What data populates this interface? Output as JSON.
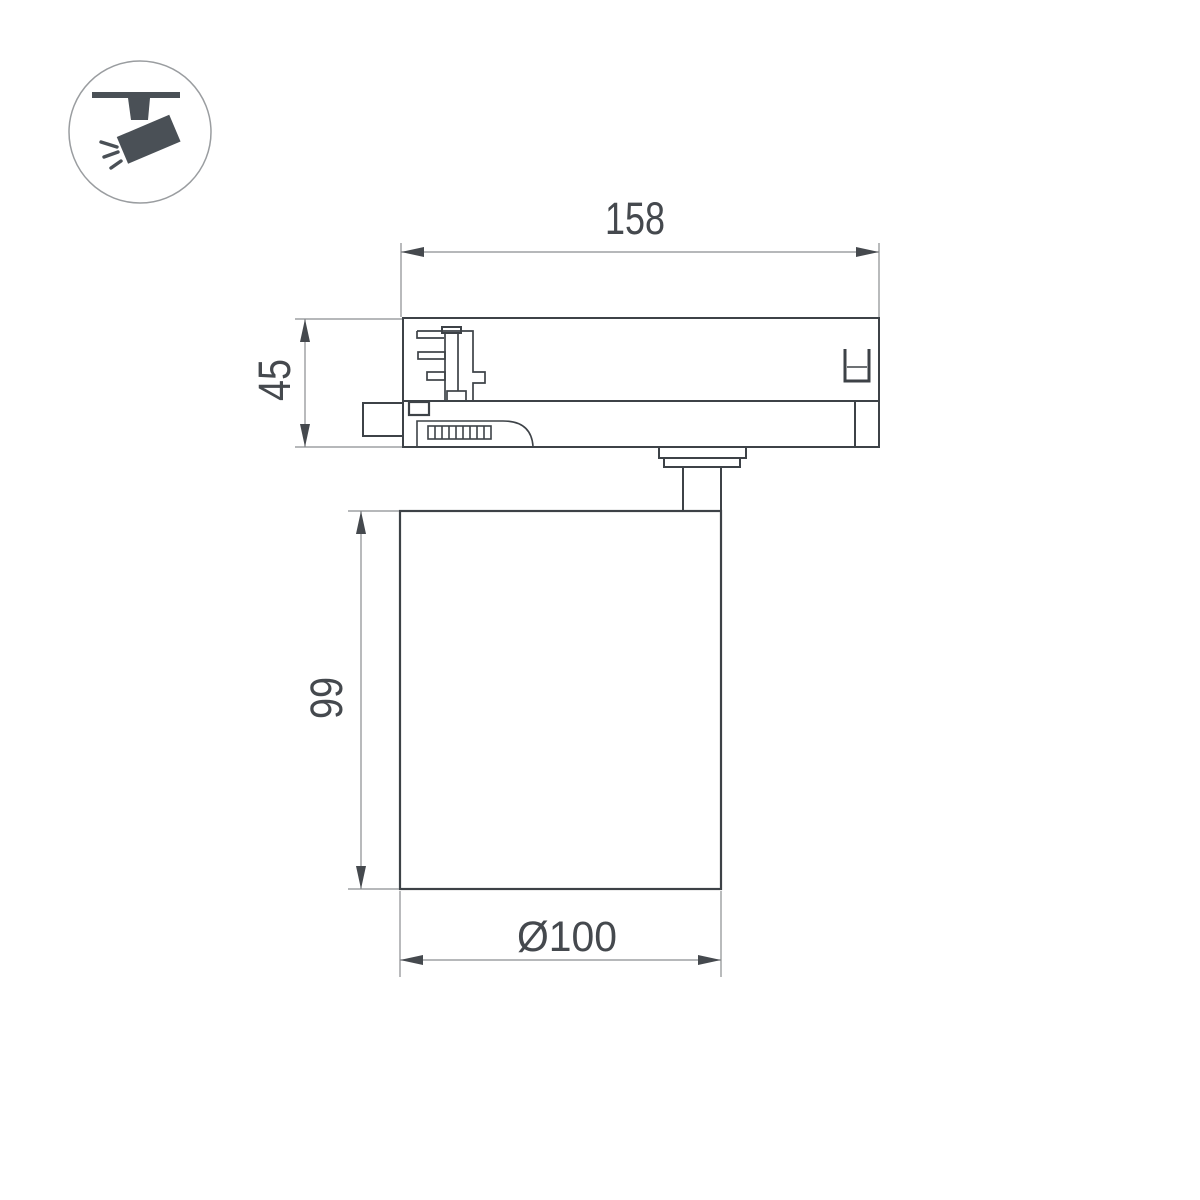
{
  "meta": {
    "type": "technical-dimension-drawing",
    "subject": "track-mounted-spotlight-side-view",
    "background": "#ffffff"
  },
  "colors": {
    "outline": "#3d4247",
    "dim_line": "#8a8d90",
    "dim_text": "#45494e",
    "icon_fill": "#4a5056",
    "icon_circle_border": "#9a9da0"
  },
  "icon": {
    "name": "track-spotlight-icon",
    "description": "ceiling track with tilted spotlight and light rays"
  },
  "dimensions": {
    "adapter_width": {
      "label": "158",
      "value": 158,
      "orientation": "horizontal-top"
    },
    "adapter_height": {
      "label": "45",
      "value": 45,
      "orientation": "vertical-left"
    },
    "body_height": {
      "label": "99",
      "value": 99,
      "orientation": "vertical-left"
    },
    "body_diameter": {
      "label": "Ø100",
      "value": 100,
      "orientation": "horizontal-bottom"
    }
  },
  "parts": {
    "track_adapter": "track adapter with contact block, latch grip and clip",
    "lamp_body": "cylindrical lamp body on stem"
  }
}
